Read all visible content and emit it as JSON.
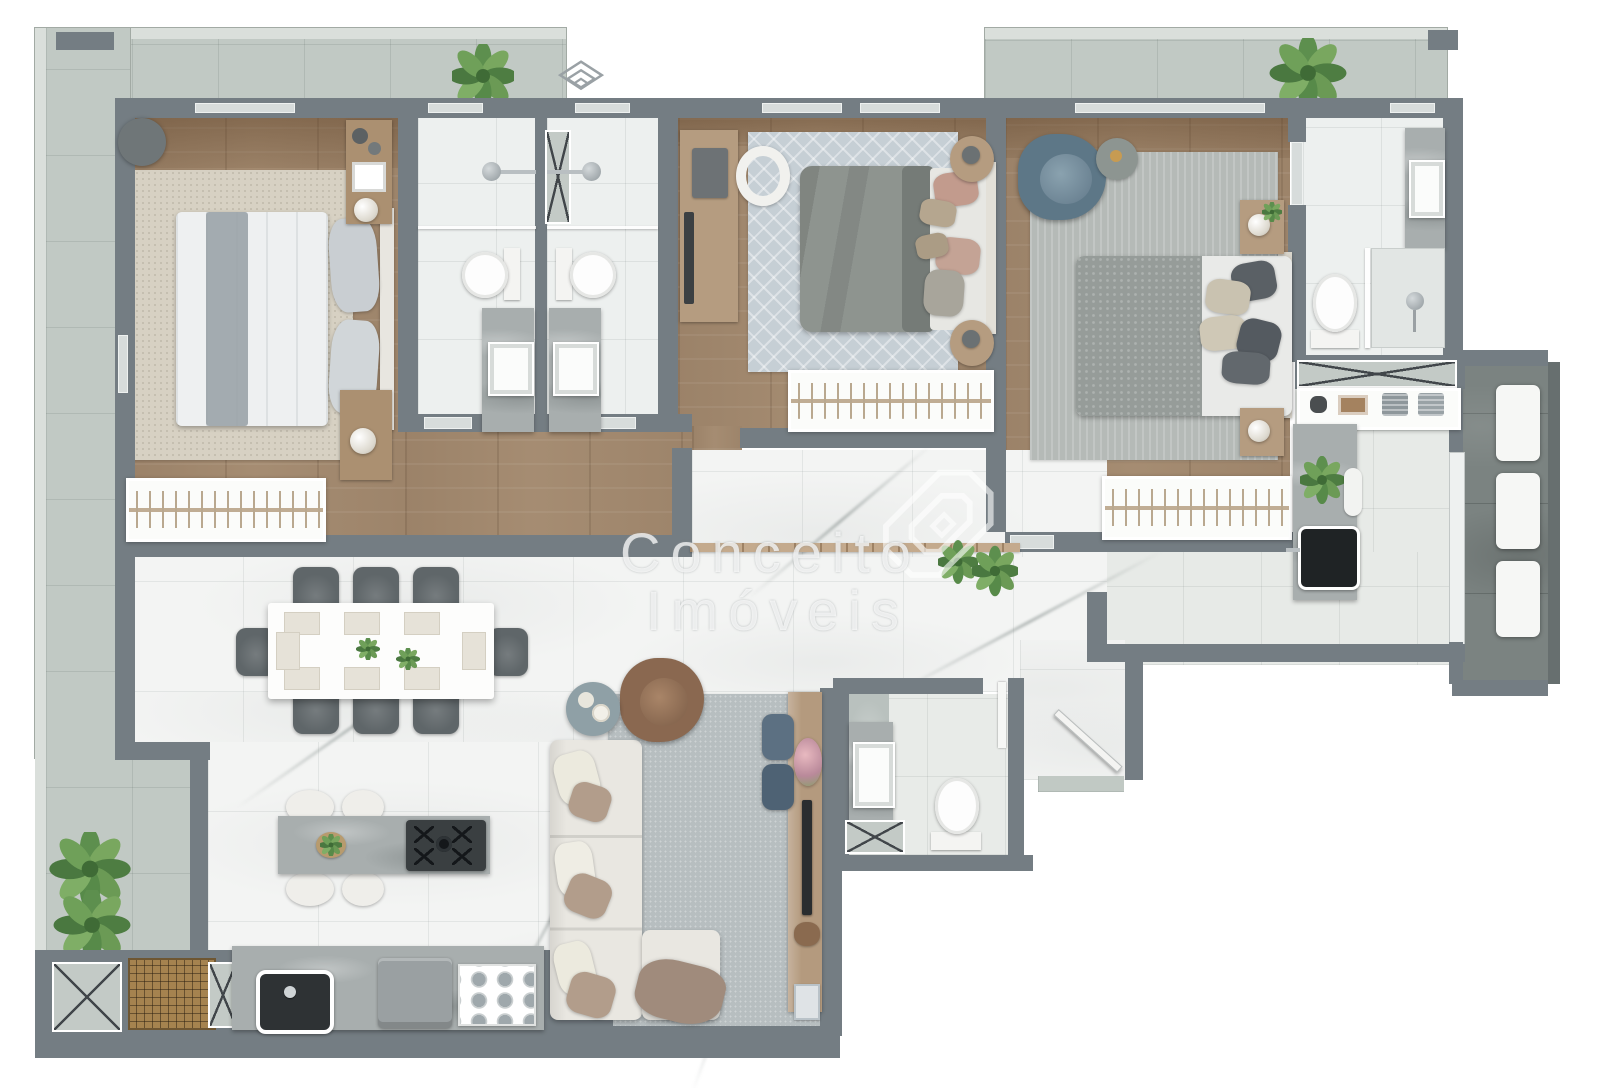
{
  "watermark": {
    "line1": "Conceito",
    "line2": "Imóveis",
    "logo": "house-outline-icon"
  },
  "corner_logo": {
    "icon": "nested-diamonds-icon"
  },
  "palette": {
    "wall": "#747d83",
    "balcony_stone": "#c1c9c4",
    "balcony_rim": "#dadfdb",
    "terrace_stone": "#7b8381",
    "wood_floor": "#a58c72",
    "marble_floor": "#f3f4f3",
    "bath_tile": "#edf0ef",
    "counter_marble": "#a8aeae",
    "rug_beige": "#d7d1c3",
    "rug_blue_pattern": "#c6cfd5",
    "rug_gray": "#b5bab7",
    "rug_living": "#b7bec0",
    "sofa_cream": "#e9e7e1",
    "armchair_brown": "#8a6850",
    "armchair_blue": "#5d7787",
    "chair_gray": "#5f6669",
    "pouf_blue": "#5c7082",
    "plant_green": "#5d8f4e",
    "fixture_white": "#fbfcfb"
  },
  "rooms": {
    "bedroom_left": {
      "furniture": [
        "double-bed",
        "beige-rug",
        "corner-pouf",
        "shelf-unit",
        "nightstand-with-lamp",
        "wardrobe-rack"
      ]
    },
    "bathroom_1": {
      "furniture": [
        "shower",
        "toilet",
        "vanity-sink"
      ]
    },
    "bathroom_2": {
      "furniture": [
        "shower",
        "toilet",
        "vanity-sink"
      ]
    },
    "bedroom_middle": {
      "furniture": [
        "double-bed",
        "desk-with-laptop",
        "desk-chair",
        "diamond-rug",
        "round-nightstand-x2",
        "wardrobe-rack"
      ]
    },
    "bedroom_master": {
      "furniture": [
        "double-bed",
        "blue-armchair",
        "round-side-table",
        "striped-rug",
        "nightstand-x2",
        "wardrobe-rack"
      ]
    },
    "bathroom_master": {
      "furniture": [
        "vanity-sink",
        "toilet",
        "shower"
      ]
    },
    "living_room": {
      "furniture": [
        "l-shaped-sofa",
        "brown-armchair",
        "round-side-table",
        "gray-rug",
        "tv-console",
        "tv",
        "blue-pouf-x2",
        "flower-vase"
      ]
    },
    "dining_area": {
      "furniture": [
        "white-table",
        "gray-chair-x8",
        "placemats",
        "green-centerpieces"
      ]
    },
    "kitchen": {
      "furniture": [
        "island-counter",
        "cooktop-5-burner",
        "white-stool-x4",
        "counter-with-sink",
        "appliance",
        "glass-tray"
      ]
    },
    "laundry_service": {
      "furniture": [
        "marble-counter",
        "dark-sink",
        "storage-shelf",
        "plant"
      ]
    },
    "powder_room": {
      "furniture": [
        "vanity-sink",
        "toilet",
        "service-shaft"
      ]
    },
    "outdoor": {
      "furniture": [
        "balcony-plants",
        "terrace-lounger-x3",
        "wood-deck-grate",
        "service-shaft-x2",
        "entry-door"
      ]
    }
  }
}
